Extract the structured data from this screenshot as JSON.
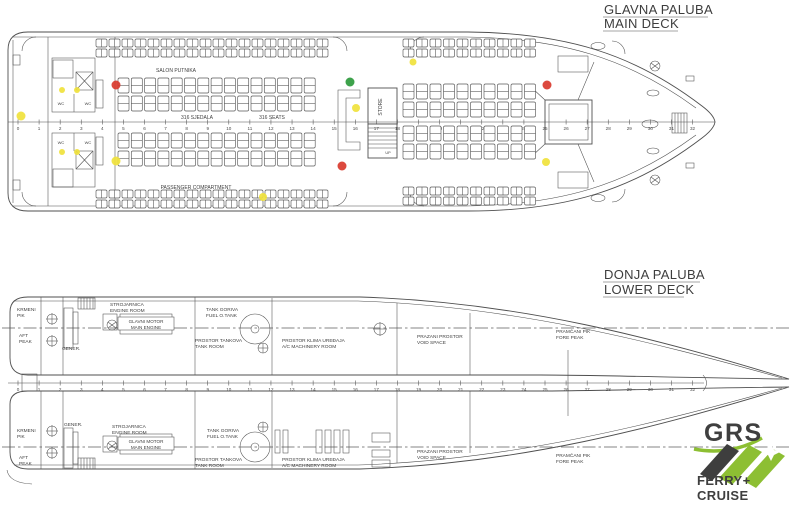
{
  "palette": {
    "ink": "#4a4a4a",
    "red": "#d93a2e",
    "yellow": "#f0e23c",
    "green": "#2c9a3c",
    "logo_green": "#8dbf33",
    "logo_dark": "#3e3e3e"
  },
  "titles": {
    "main_hr": "GLAVNA PALUBA",
    "main_en": "MAIN DECK",
    "lower_hr": "DONJA PALUBA",
    "lower_en": "LOWER DECK"
  },
  "main_deck": {
    "frame_ruler": {
      "x0": 18,
      "dx": 21.08,
      "count": 33,
      "y": 122,
      "num_dy": 8,
      "x1": 8,
      "x2": 715
    },
    "labels": [
      {
        "name": "salon-putnika-label",
        "text": "SALON PUTNIKA",
        "x": 176,
        "y": 72,
        "size": 5,
        "anchor": "middle"
      },
      {
        "name": "seats-count-hr",
        "text": "316 SJEDALA",
        "x": 197,
        "y": 119,
        "size": 5,
        "anchor": "middle"
      },
      {
        "name": "seats-count-en",
        "text": "316 SEATS",
        "x": 272,
        "y": 119,
        "size": 5,
        "anchor": "middle"
      },
      {
        "name": "passenger-compartment-label",
        "text": "PASSENGER COMPARTMENT",
        "x": 196,
        "y": 189,
        "size": 5,
        "anchor": "middle"
      },
      {
        "name": "store-label",
        "text": "STORE",
        "x": 382,
        "y": 107,
        "size": 5,
        "anchor": "middle",
        "rotate": -90
      },
      {
        "name": "up-label",
        "text": "UP",
        "x": 388,
        "y": 154,
        "size": 3.8,
        "anchor": "middle"
      },
      {
        "name": "wc-label-1",
        "text": "WC",
        "x": 61,
        "y": 105,
        "size": 4,
        "anchor": "middle"
      },
      {
        "name": "wc-label-2",
        "text": "WC",
        "x": 88,
        "y": 105,
        "size": 4,
        "anchor": "middle"
      },
      {
        "name": "wc-label-3",
        "text": "WC",
        "x": 61,
        "y": 144,
        "size": 4,
        "anchor": "middle"
      },
      {
        "name": "wc-label-4",
        "text": "WC",
        "x": 88,
        "y": 144,
        "size": 4,
        "anchor": "middle"
      }
    ],
    "markers": [
      {
        "c": "yellow",
        "x": 21,
        "y": 116,
        "r": 4.5
      },
      {
        "c": "yellow",
        "x": 62,
        "y": 90,
        "r": 3
      },
      {
        "c": "yellow",
        "x": 77,
        "y": 90,
        "r": 3
      },
      {
        "c": "yellow",
        "x": 62,
        "y": 152,
        "r": 3
      },
      {
        "c": "yellow",
        "x": 77,
        "y": 152,
        "r": 3
      },
      {
        "c": "red",
        "x": 116,
        "y": 85,
        "r": 4.5
      },
      {
        "c": "yellow",
        "x": 116,
        "y": 161,
        "r": 4.5
      },
      {
        "c": "yellow",
        "x": 263,
        "y": 197,
        "r": 4
      },
      {
        "c": "green",
        "x": 350,
        "y": 82,
        "r": 4.5
      },
      {
        "c": "yellow",
        "x": 356,
        "y": 108,
        "r": 4
      },
      {
        "c": "red",
        "x": 342,
        "y": 166,
        "r": 4.5
      },
      {
        "c": "yellow",
        "x": 413,
        "y": 62,
        "r": 3.5
      },
      {
        "c": "red",
        "x": 547,
        "y": 85,
        "r": 4.5
      },
      {
        "c": "yellow",
        "x": 546,
        "y": 162,
        "r": 4
      }
    ],
    "seat_banks": [
      {
        "x": 96,
        "y": 39,
        "cols": 18,
        "rows": 2,
        "px": 13,
        "py": 10,
        "w": 11,
        "h": 8
      },
      {
        "x": 403,
        "y": 39,
        "cols": 10,
        "rows": 2,
        "px": 13.5,
        "py": 10,
        "w": 11,
        "h": 8
      },
      {
        "x": 118,
        "y": 78,
        "cols": 15,
        "rows": 2,
        "px": 13.3,
        "py": 18,
        "w": 11,
        "h": 15
      },
      {
        "x": 118,
        "y": 133,
        "cols": 15,
        "rows": 2,
        "px": 13.3,
        "py": 18,
        "w": 11,
        "h": 15
      },
      {
        "x": 403,
        "y": 84,
        "cols": 10,
        "rows": 2,
        "px": 13.5,
        "py": 18,
        "w": 11,
        "h": 15
      },
      {
        "x": 403,
        "y": 126,
        "cols": 10,
        "rows": 2,
        "px": 13.5,
        "py": 18,
        "w": 11,
        "h": 15
      },
      {
        "x": 96,
        "y": 190,
        "cols": 18,
        "rows": 2,
        "px": 13,
        "py": 10,
        "w": 11,
        "h": 8
      },
      {
        "x": 403,
        "y": 187,
        "cols": 10,
        "rows": 2,
        "px": 13.5,
        "py": 10,
        "w": 11,
        "h": 8
      }
    ]
  },
  "lower_deck": {
    "frame_ruler": {
      "x0": 18,
      "dx": 21.08,
      "count": 33,
      "y": 383,
      "num_dy": 8,
      "x1": 8,
      "x2": 704
    },
    "labels": [
      {
        "name": "aft-peak-hr-1-top",
        "text": "KRMENI",
        "x": 17,
        "y": 311,
        "size": 4.8
      },
      {
        "name": "aft-peak-hr-2-top",
        "text": "PIK",
        "x": 17,
        "y": 317,
        "size": 4.8
      },
      {
        "name": "aft-peak-en-1-top",
        "text": "AFT",
        "x": 19,
        "y": 337,
        "size": 4.8
      },
      {
        "name": "aft-peak-en-2-top",
        "text": "PEAK",
        "x": 19,
        "y": 343,
        "size": 4.8
      },
      {
        "name": "generator-label-top",
        "text": "GENER.",
        "x": 62,
        "y": 350,
        "size": 4.8
      },
      {
        "name": "engine-room-hr-top",
        "text": "STROJARNICA",
        "x": 110,
        "y": 306,
        "size": 4.8
      },
      {
        "name": "engine-room-en-top",
        "text": "ENGINE ROOM",
        "x": 110,
        "y": 312,
        "size": 4.8
      },
      {
        "name": "main-engine-hr-top",
        "text": "GLAVNI MOTOR",
        "x": 146,
        "y": 323,
        "size": 4.6,
        "anchor": "middle"
      },
      {
        "name": "main-engine-en-top",
        "text": "MAIN ENGINE",
        "x": 146,
        "y": 329,
        "size": 4.6,
        "anchor": "middle"
      },
      {
        "name": "fuel-tank-hr-top",
        "text": "TANK GORIVA",
        "x": 206,
        "y": 311,
        "size": 4.8
      },
      {
        "name": "fuel-tank-en-top",
        "text": "FUEL O.TANK",
        "x": 206,
        "y": 317,
        "size": 4.8
      },
      {
        "name": "tank-room-hr-top",
        "text": "PROSTOR TANKOVA",
        "x": 195,
        "y": 342,
        "size": 4.8
      },
      {
        "name": "tank-room-en-top",
        "text": "TANK ROOM",
        "x": 195,
        "y": 348,
        "size": 4.8
      },
      {
        "name": "ac-room-hr-top",
        "text": "PROSTOR KLIMA UREĐAJA",
        "x": 282,
        "y": 342,
        "size": 4.8
      },
      {
        "name": "ac-room-en-top",
        "text": "A/C MACHINERY ROOM",
        "x": 282,
        "y": 348,
        "size": 4.8
      },
      {
        "name": "void-space-hr-top",
        "text": "PRAZANI PROSTOR",
        "x": 417,
        "y": 338,
        "size": 4.8
      },
      {
        "name": "void-space-en-top",
        "text": "VOID SPACE",
        "x": 417,
        "y": 344,
        "size": 4.8
      },
      {
        "name": "fore-peak-hr-top",
        "text": "PRAMČANI PIK",
        "x": 556,
        "y": 333,
        "size": 4.8
      },
      {
        "name": "fore-peak-en-top",
        "text": "FORE PEAK",
        "x": 556,
        "y": 339,
        "size": 4.8
      },
      {
        "name": "aft-peak-hr-1-bot",
        "text": "KRMENI",
        "x": 17,
        "y": 432,
        "size": 4.8
      },
      {
        "name": "aft-peak-hr-2-bot",
        "text": "PIK",
        "x": 17,
        "y": 438,
        "size": 4.8
      },
      {
        "name": "aft-peak-en-1-bot",
        "text": "AFT",
        "x": 19,
        "y": 459,
        "size": 4.8
      },
      {
        "name": "aft-peak-en-2-bot",
        "text": "PEAK",
        "x": 19,
        "y": 465,
        "size": 4.8
      },
      {
        "name": "generator-label-bot",
        "text": "GENER.",
        "x": 64,
        "y": 426,
        "size": 4.8
      },
      {
        "name": "engine-room-hr-bot",
        "text": "STROJARNICA",
        "x": 112,
        "y": 428,
        "size": 4.8
      },
      {
        "name": "engine-room-en-bot",
        "text": "ENGINE ROOM",
        "x": 112,
        "y": 434,
        "size": 4.8
      },
      {
        "name": "main-engine-hr-bot",
        "text": "GLAVNI MOTOR",
        "x": 146,
        "y": 443,
        "size": 4.6,
        "anchor": "middle"
      },
      {
        "name": "main-engine-en-bot",
        "text": "MAIN ENGINE",
        "x": 146,
        "y": 449,
        "size": 4.6,
        "anchor": "middle"
      },
      {
        "name": "fuel-tank-hr-bot",
        "text": "TANK GORIVA",
        "x": 207,
        "y": 432,
        "size": 4.8
      },
      {
        "name": "fuel-tank-en-bot",
        "text": "FUEL O.TANK",
        "x": 207,
        "y": 438,
        "size": 4.8
      },
      {
        "name": "tank-room-hr-bot",
        "text": "PROSTOR TANKOVA",
        "x": 195,
        "y": 461,
        "size": 4.8
      },
      {
        "name": "tank-room-en-bot",
        "text": "TANK ROOM",
        "x": 195,
        "y": 467,
        "size": 4.8
      },
      {
        "name": "ac-room-hr-bot",
        "text": "PROSTOR KLIMA UREĐAJA",
        "x": 282,
        "y": 461,
        "size": 4.8
      },
      {
        "name": "ac-room-en-bot",
        "text": "A/C MACHINERY ROOM",
        "x": 282,
        "y": 467,
        "size": 4.8
      },
      {
        "name": "void-space-hr-bot",
        "text": "PRAZANI PROSTOR",
        "x": 417,
        "y": 453,
        "size": 4.8
      },
      {
        "name": "void-space-en-bot",
        "text": "VOID SPACE",
        "x": 417,
        "y": 459,
        "size": 4.8
      },
      {
        "name": "fore-peak-hr-bot",
        "text": "PRAMČANI PIK",
        "x": 556,
        "y": 457,
        "size": 4.8
      },
      {
        "name": "fore-peak-en-bot",
        "text": "FORE PEAK",
        "x": 556,
        "y": 463,
        "size": 4.8
      }
    ],
    "bulkheads": {
      "top": [
        [
          41,
          297,
          375
        ],
        [
          63,
          297,
          375
        ],
        [
          195,
          297,
          375
        ],
        [
          272,
          298,
          375
        ],
        [
          397,
          303,
          375
        ],
        [
          470,
          313,
          375
        ]
      ],
      "bottom": [
        [
          41,
          391,
          469
        ],
        [
          63,
          391,
          469
        ],
        [
          195,
          391,
          469
        ],
        [
          272,
          391,
          468
        ],
        [
          397,
          391,
          463
        ],
        [
          470,
          391,
          453
        ]
      ],
      "collision": [
        568,
        350,
        416
      ]
    }
  },
  "logo": {
    "grs": "GRS",
    "ferry": "FERRY+",
    "cruise": "CRUISE"
  }
}
